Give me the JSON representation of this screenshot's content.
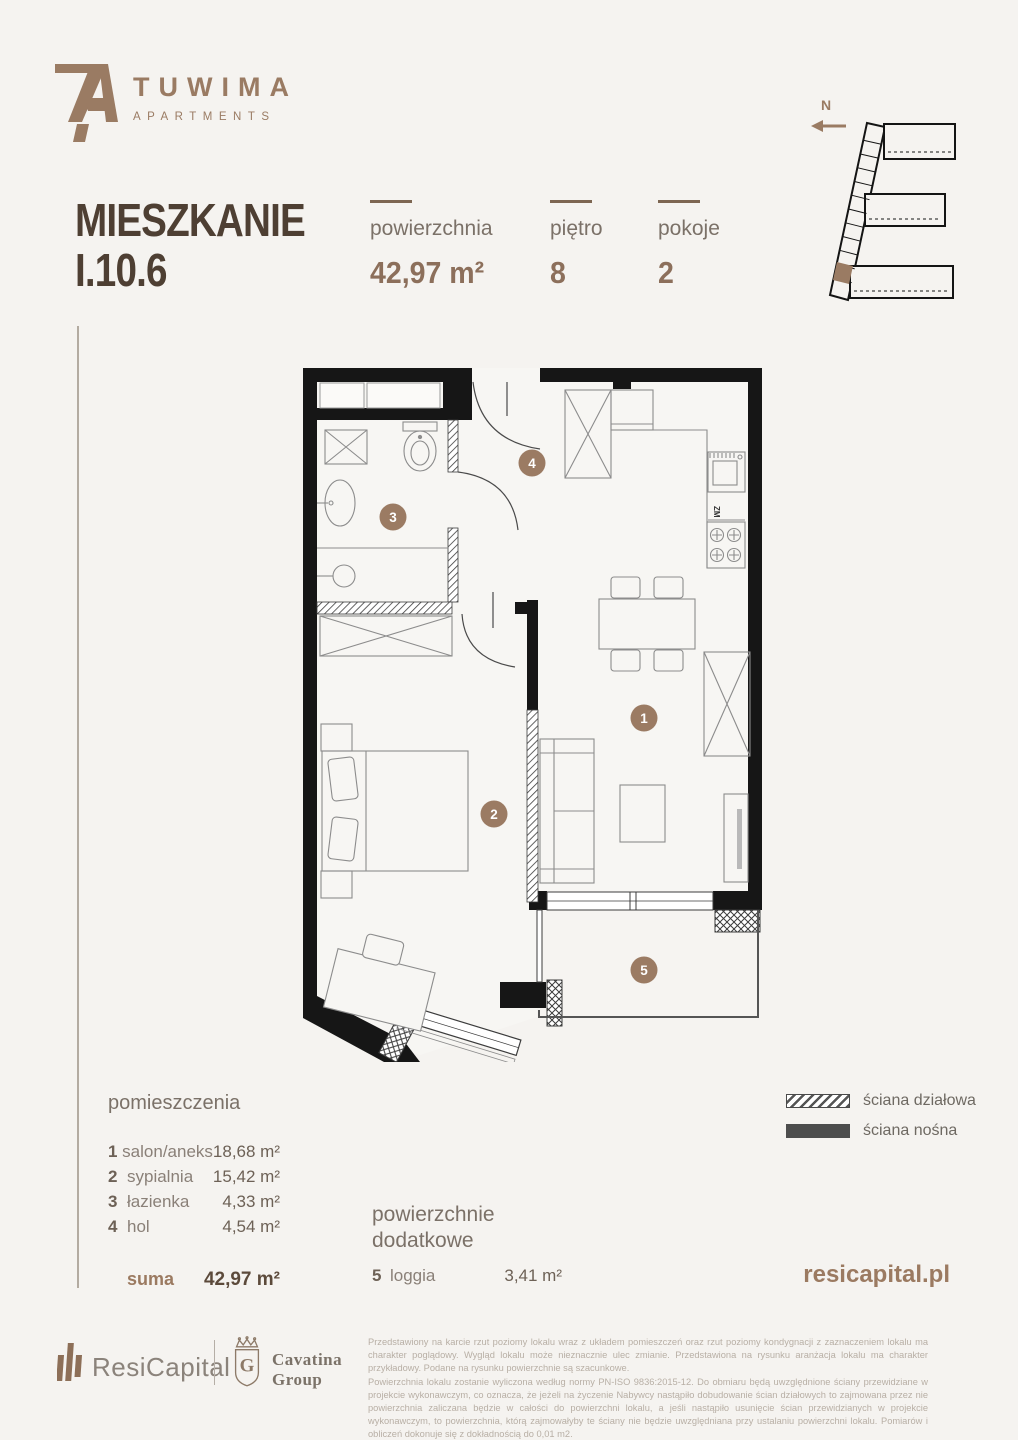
{
  "colors": {
    "background": "#f5f3f0",
    "accent": "#9a7b63",
    "dark_text": "#4e3f33",
    "wall_black": "#161616"
  },
  "header": {
    "logo": {
      "brand": "TUWIMA",
      "sub": "APARTMENTS"
    },
    "title_line1": "MIESZKANIE",
    "title_line2": "I.10.6",
    "stats": [
      {
        "label": "powierzchnia",
        "value": "42,97 m²"
      },
      {
        "label": "piętro",
        "value": "8"
      },
      {
        "label": "pokoje",
        "value": "2"
      }
    ],
    "north_label": "N"
  },
  "plan": {
    "room_labels": [
      "1",
      "2",
      "3",
      "4",
      "5"
    ],
    "kitchen_label": "ZM"
  },
  "legend": [
    {
      "label": "ściana działowa"
    },
    {
      "label": "ściana nośna"
    }
  ],
  "rooms": {
    "header": "pomieszczenia",
    "items": [
      {
        "no": "1",
        "name": "salon/aneks",
        "area": "18,68 m²"
      },
      {
        "no": "2",
        "name": "sypialnia",
        "area": "15,42 m²"
      },
      {
        "no": "3",
        "name": "łazienka",
        "area": "4,33 m²"
      },
      {
        "no": "4",
        "name": "hol",
        "area": "4,54 m²"
      }
    ],
    "suma_label": "suma",
    "suma_value": "42,97 m²"
  },
  "additional": {
    "header_line1": "powierzchnie",
    "header_line2": "dodatkowe",
    "items": [
      {
        "no": "5",
        "name": "loggia",
        "area": "3,41 m²"
      }
    ]
  },
  "website": "resicapital.pl",
  "footer": {
    "resicapital": "ResiCapital",
    "cavatina_line1": "Cavatina",
    "cavatina_line2": "Group",
    "cavatina_monogram": "G",
    "disclaimer": [
      "Przedstawiony na karcie rzut poziomy lokalu wraz z układem pomieszczeń oraz rzut poziomy kondygnacji z zaznaczeniem lokalu ma charakter poglądowy. Wygląd lokalu może nieznacznie ulec zmianie. Przedstawiona na rysunku aranżacja lokalu ma charakter przykładowy. Podane na rysunku powierzchnie są szacunkowe.",
      "Powierzchnia lokalu zostanie wyliczona według normy PN-ISO 9836:2015-12. Do obmiaru będą uwzględnione ściany przewidziane w projekcie wykonawczym, co oznacza, że jeżeli na życzenie Nabywcy nastąpiło dobudowanie ścian działowych to zajmowana przez nie powierzchnia zaliczana będzie w całości do powierzchni lokalu, a jeśli nastąpiło usunięcie ścian przewidzianych w projekcie wykonawczym, to powierzchnia, którą zajmowałyby te ściany nie będzie uwzględniana przy ustalaniu powierzchni lokalu. Pomiarów i obliczeń dokonuje się z dokładnością do 0,01 m2.",
      "Powyższa karta ma charakter informacyjny i nie stanowi oferty handlowej w rozumieniu art. 66 §1 Kodeksu Cywilnego (Dz.U. Nr 16, poz. 93 z późn. zm.)."
    ]
  }
}
